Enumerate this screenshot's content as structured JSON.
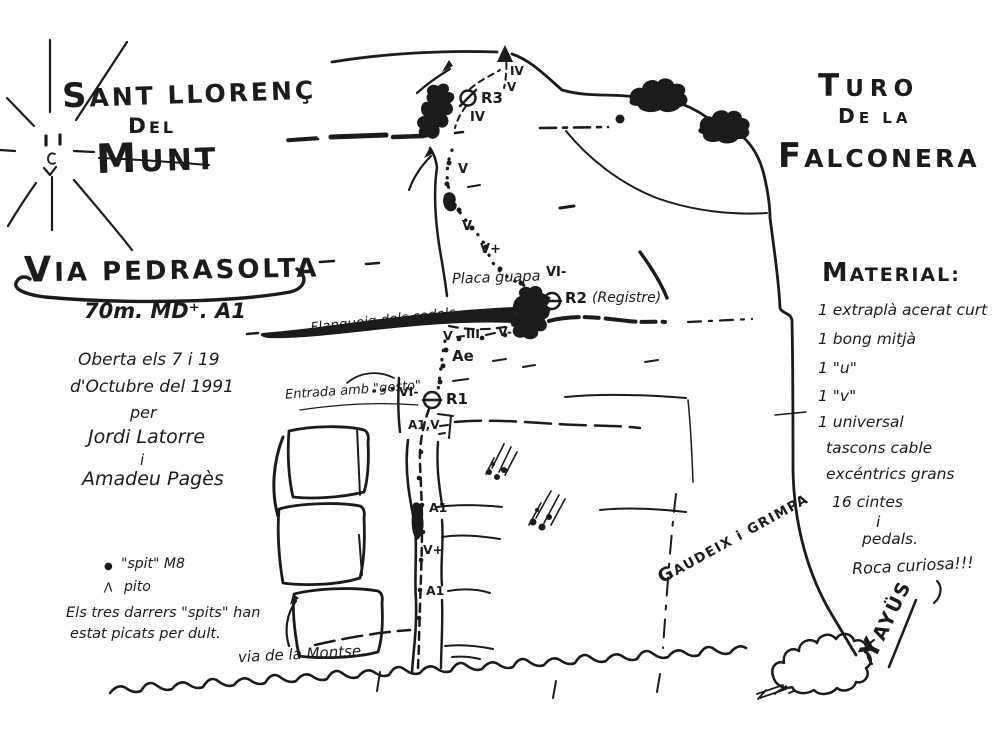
{
  "colors": {
    "ink": "#1b1b1b",
    "paper": "#ffffff"
  },
  "massif": {
    "line1": "SANT LLORENÇ",
    "line2": "DEL",
    "line3": "MUNT"
  },
  "peak": {
    "line1": "TURO",
    "line2": "DE LA",
    "line3": "FALCONERA"
  },
  "route": {
    "name": "VIA PEDRASOLTA",
    "specs": "70m. MD⁺. A1",
    "opening": [
      "Oberta els 7 i 19",
      "d'Octubre del 1991",
      "per",
      "Jordi Latorre",
      "i",
      "Amadeu Pagès"
    ],
    "grades": [
      "IV",
      "V",
      "IV",
      "V",
      "V",
      "V+",
      "VI-",
      "V",
      "III",
      "V-",
      "Ae",
      "VI-",
      "A1,V",
      "A1",
      "V+",
      "A1"
    ],
    "belays": [
      "R3",
      "R2",
      "R1"
    ],
    "registre_note": "(Registre)"
  },
  "legend": {
    "spit": {
      "symbol_glyph": "●",
      "label": "\"spit\" M8"
    },
    "pito": {
      "symbol_glyph": "Λ",
      "label": "pito"
    },
    "note1": "Els tres darrers \"spits\" han",
    "note2": "estat picats per dult."
  },
  "material": {
    "heading": "MATERIAL:",
    "items": [
      "1 extraplà acerat curt",
      "1 bong mitjà",
      "1 \"u\"",
      "1 \"v\"",
      "1 universal",
      "tascons cable",
      "excéntrics grans",
      "16 cintes",
      "i",
      "pedals."
    ],
    "closing": "Roca curiosa!!!"
  },
  "labels": {
    "placa": "Placa guapa",
    "flanqueig": "Flanqueig dels codols",
    "entrada": "Entrada amb \"gesto\"",
    "other_route": "via de la Montse",
    "motto": "GAUDEIX i GRIMPA",
    "signature": "YAYÜS"
  }
}
